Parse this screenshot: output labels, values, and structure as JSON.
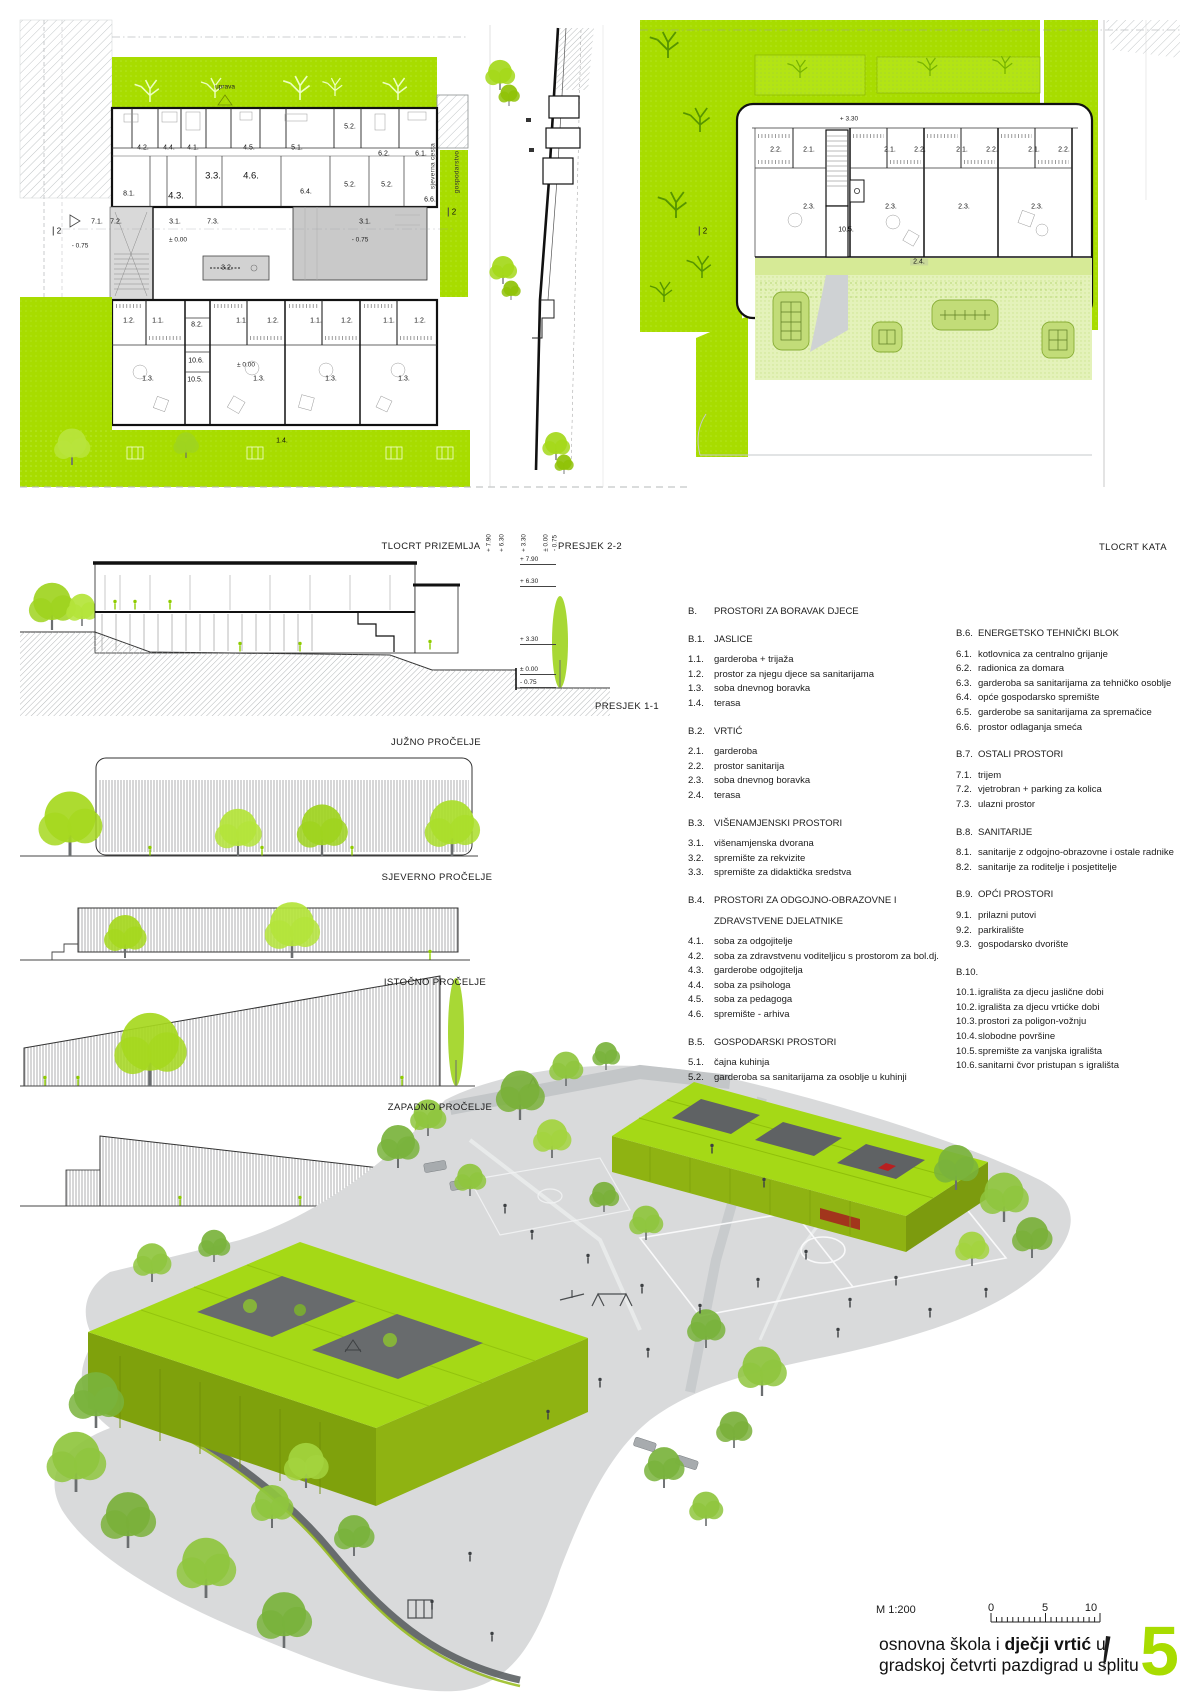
{
  "colors": {
    "accent_green": "#a8dc00",
    "roof_green": "#a5d916",
    "building_face_green": "#8fb312",
    "light_green": "#e4f2ba",
    "terrace_green": "#d6ea96",
    "hall_gray": "#c9c9c9",
    "render_ground_gray": "#d9dadb",
    "red_accent": "#b82020"
  },
  "captions": {
    "ground_plan": "TLOCRT PRIZEMLJA",
    "section22": "PRESJEK 2-2",
    "upper_plan": "TLOCRT KATA",
    "section11": "PRESJEK 1-1",
    "south_elev": "JUŽNO PROČELJE",
    "north_elev": "SJEVERNO PROČELJE",
    "east_elev": "ISTOČNO PROČELJE",
    "west_elev": "ZAPADNO PROČELJE"
  },
  "caption_levels": [
    {
      "t": "+ 7.90",
      "x": 489,
      "y": 543
    },
    {
      "t": "+ 6.30",
      "x": 502,
      "y": 543
    },
    {
      "t": "+ 3.30",
      "x": 524,
      "y": 543
    },
    {
      "t": "± 0.00",
      "x": 546,
      "y": 543
    },
    {
      "t": "- 0.75",
      "x": 555,
      "y": 543
    }
  ],
  "ground_plan": {
    "labels": [
      {
        "t": "4.2.",
        "x": 143,
        "y": 148
      },
      {
        "t": "4.4.",
        "x": 169,
        "y": 148
      },
      {
        "t": "4.1.",
        "x": 193,
        "y": 148
      },
      {
        "t": "4.5.",
        "x": 249,
        "y": 148
      },
      {
        "t": "5.1.",
        "x": 297,
        "y": 148
      },
      {
        "t": "5.2.",
        "x": 350,
        "y": 127
      },
      {
        "t": "6.2.",
        "x": 384,
        "y": 154
      },
      {
        "t": "6.1.",
        "x": 421,
        "y": 154
      },
      {
        "t": "3.3.",
        "x": 213,
        "y": 176,
        "c": "big"
      },
      {
        "t": "4.6.",
        "x": 251,
        "y": 176,
        "c": "big"
      },
      {
        "t": "8.1.",
        "x": 129,
        "y": 194
      },
      {
        "t": "4.3.",
        "x": 176,
        "y": 196,
        "c": "big"
      },
      {
        "t": "6.4.",
        "x": 306,
        "y": 192
      },
      {
        "t": "5.2.",
        "x": 350,
        "y": 185
      },
      {
        "t": "5.2.",
        "x": 387,
        "y": 185
      },
      {
        "t": "6.6.",
        "x": 430,
        "y": 200
      },
      {
        "t": "7.1.",
        "x": 97,
        "y": 222
      },
      {
        "t": "7.2.",
        "x": 116,
        "y": 222
      },
      {
        "t": "3.1.",
        "x": 175,
        "y": 222
      },
      {
        "t": "7.3.",
        "x": 213,
        "y": 222
      },
      {
        "t": "± 0.00",
        "x": 178,
        "y": 240,
        "c": "lv"
      },
      {
        "t": "3.2.",
        "x": 227,
        "y": 268
      },
      {
        "t": "3.1.",
        "x": 365,
        "y": 222
      },
      {
        "t": "- 0.75",
        "x": 360,
        "y": 240,
        "c": "lv"
      },
      {
        "t": "- 0.75",
        "x": 80,
        "y": 246,
        "c": "lv"
      },
      {
        "t": "2",
        "x": 57,
        "y": 231,
        "c": "mark"
      },
      {
        "t": "2",
        "x": 452,
        "y": 212,
        "c": "mark"
      },
      {
        "t": "1.2.",
        "x": 129,
        "y": 321
      },
      {
        "t": "1.1.",
        "x": 158,
        "y": 321
      },
      {
        "t": "8.2.",
        "x": 197,
        "y": 325
      },
      {
        "t": "1.1.",
        "x": 242,
        "y": 321
      },
      {
        "t": "1.2.",
        "x": 273,
        "y": 321
      },
      {
        "t": "1.1.",
        "x": 316,
        "y": 321
      },
      {
        "t": "1.2.",
        "x": 347,
        "y": 321
      },
      {
        "t": "1.1.",
        "x": 389,
        "y": 321
      },
      {
        "t": "1.2.",
        "x": 420,
        "y": 321
      },
      {
        "t": "10.6.",
        "x": 196,
        "y": 361
      },
      {
        "t": "10.5.",
        "x": 195,
        "y": 380
      },
      {
        "t": "± 0.00",
        "x": 246,
        "y": 365,
        "c": "lv"
      },
      {
        "t": "1.3.",
        "x": 148,
        "y": 379
      },
      {
        "t": "1.3.",
        "x": 259,
        "y": 379
      },
      {
        "t": "1.3.",
        "x": 331,
        "y": 379
      },
      {
        "t": "1.3.",
        "x": 404,
        "y": 379
      },
      {
        "t": "1.4.",
        "x": 282,
        "y": 441
      },
      {
        "t": "uprava",
        "x": 225,
        "y": 87,
        "c": "lv"
      },
      {
        "t": "sjeverna cesta",
        "x": 433,
        "y": 166,
        "c": "rot"
      },
      {
        "t": "gospodarstvo",
        "x": 457,
        "y": 172,
        "c": "rot"
      }
    ]
  },
  "upper_plan": {
    "labels": [
      {
        "t": "+ 3.30",
        "x": 849,
        "y": 119,
        "c": "lv"
      },
      {
        "t": "2.2.",
        "x": 776,
        "y": 150
      },
      {
        "t": "2.1.",
        "x": 809,
        "y": 150
      },
      {
        "t": "2.1.",
        "x": 890,
        "y": 150
      },
      {
        "t": "2.2.",
        "x": 920,
        "y": 150
      },
      {
        "t": "2.1.",
        "x": 962,
        "y": 150
      },
      {
        "t": "2.2.",
        "x": 992,
        "y": 150
      },
      {
        "t": "2.1.",
        "x": 1034,
        "y": 150
      },
      {
        "t": "2.2.",
        "x": 1064,
        "y": 150
      },
      {
        "t": "2.3.",
        "x": 809,
        "y": 207
      },
      {
        "t": "2.3.",
        "x": 891,
        "y": 207
      },
      {
        "t": "2.3.",
        "x": 964,
        "y": 207
      },
      {
        "t": "2.3.",
        "x": 1037,
        "y": 207
      },
      {
        "t": "10.5.",
        "x": 846,
        "y": 230
      },
      {
        "t": "2.4.",
        "x": 919,
        "y": 262,
        "c": "chip"
      },
      {
        "t": "2",
        "x": 703,
        "y": 231,
        "c": "mark"
      }
    ]
  },
  "section11": {
    "levels": [
      {
        "t": "+ 7.90",
        "x": 520,
        "y": 556
      },
      {
        "t": "+ 6.30",
        "x": 520,
        "y": 578
      },
      {
        "t": "+ 3.30",
        "x": 520,
        "y": 636
      },
      {
        "t": "± 0.00",
        "x": 520,
        "y": 666
      },
      {
        "t": "- 0.75",
        "x": 520,
        "y": 679
      }
    ]
  },
  "legend": {
    "col1": [
      {
        "n": "B.",
        "t": "PROSTORI ZA BORAVAK DJECE",
        "c": "head"
      },
      {
        "n": "B.1.",
        "t": "JASLICE",
        "c": "head"
      },
      {
        "n": "1.1.",
        "t": "garderoba + trijaža"
      },
      {
        "n": "1.2.",
        "t": "prostor za njegu djece sa sanitarijama"
      },
      {
        "n": "1.3.",
        "t": "soba dnevnog boravka"
      },
      {
        "n": "1.4.",
        "t": "terasa"
      },
      {
        "n": "B.2.",
        "t": "VRTIĆ",
        "c": "head"
      },
      {
        "n": "2.1.",
        "t": "garderoba"
      },
      {
        "n": "2.2.",
        "t": "prostor sanitarija"
      },
      {
        "n": "2.3.",
        "t": "soba dnevnog boravka"
      },
      {
        "n": "2.4.",
        "t": "terasa"
      },
      {
        "n": "B.3.",
        "t": "VIŠENAMJENSKI PROSTORI",
        "c": "head"
      },
      {
        "n": "3.1.",
        "t": "višenamjenska dvorana"
      },
      {
        "n": "3.2.",
        "t": "spremište za rekvizite"
      },
      {
        "n": "3.3.",
        "t": "spremište za didaktička sredstva"
      },
      {
        "n": "B.4.",
        "t": "PROSTORI ZA ODGOJNO-OBRAZOVNE I",
        "c": "head"
      },
      {
        "n": "",
        "t": "ZDRAVSTVENE DJELATNIKE",
        "c": "head2"
      },
      {
        "n": "4.1.",
        "t": "soba za odgojitelje"
      },
      {
        "n": "4.2.",
        "t": "soba za zdravstvenu voditeljicu s prostorom za bol.dj."
      },
      {
        "n": "4.3.",
        "t": "garderobe odgojitelja"
      },
      {
        "n": "4.4.",
        "t": "soba za psihologa"
      },
      {
        "n": "4.5.",
        "t": "soba za pedagoga"
      },
      {
        "n": "4.6.",
        "t": "spremište - arhiva"
      },
      {
        "n": "B.5.",
        "t": "GOSPODARSKI PROSTORI",
        "c": "head"
      },
      {
        "n": "5.1.",
        "t": "čajna kuhinja"
      },
      {
        "n": "5.2.",
        "t": "garderoba sa sanitarijama za osoblje u kuhinji"
      }
    ],
    "col2": [
      {
        "n": "B.6.",
        "t": "ENERGETSKO TEHNIČKI BLOK",
        "c": "head"
      },
      {
        "n": "6.1.",
        "t": "kotlovnica za centralno grijanje"
      },
      {
        "n": "6.2.",
        "t": "radionica za domara"
      },
      {
        "n": "6.3.",
        "t": "garderoba sa sanitarijama za tehničko osoblje"
      },
      {
        "n": "6.4.",
        "t": "opće gospodarsko spremište"
      },
      {
        "n": "6.5.",
        "t": "garderobe sa sanitarijama za spremačice"
      },
      {
        "n": "6.6.",
        "t": "prostor odlaganja smeća"
      },
      {
        "n": "B.7.",
        "t": "OSTALI PROSTORI",
        "c": "head"
      },
      {
        "n": "7.1.",
        "t": "trijem"
      },
      {
        "n": "7.2.",
        "t": "vjetrobran + parking za kolica"
      },
      {
        "n": "7.3.",
        "t": "ulazni prostor"
      },
      {
        "n": "B.8.",
        "t": "SANITARIJE",
        "c": "head"
      },
      {
        "n": "8.1.",
        "t": "sanitarije z odgojno-obrazovne i ostale radnike"
      },
      {
        "n": "8.2.",
        "t": "sanitarije za roditelje i posjetitelje"
      },
      {
        "n": "B.9.",
        "t": "OPĆI PROSTORI",
        "c": "head"
      },
      {
        "n": "9.1.",
        "t": "prilazni putovi"
      },
      {
        "n": "9.2.",
        "t": "parkiralište"
      },
      {
        "n": "9.3.",
        "t": "gospodarsko dvorište"
      },
      {
        "n": "B.10.",
        "t": "",
        "c": "head"
      },
      {
        "n": "10.1.",
        "t": "igrališta za djecu jaslične dobi"
      },
      {
        "n": "10.2.",
        "t": "igrališta za djecu vrtićke dobi"
      },
      {
        "n": "10.3.",
        "t": "prostori za poligon-vožnju"
      },
      {
        "n": "10.4.",
        "t": "slobodne površine"
      },
      {
        "n": "10.5.",
        "t": "spremište za vanjska igrališta"
      },
      {
        "n": "10.6.",
        "t": "sanitarni čvor pristupan s igrališta"
      }
    ]
  },
  "footer": {
    "scale_label": "M 1:200",
    "ticks": [
      {
        "t": "0",
        "x": 991,
        "y": 1602
      },
      {
        "t": "5",
        "x": 1045,
        "y": 1602
      },
      {
        "t": "10",
        "x": 1091,
        "y": 1602
      }
    ],
    "title_prefix": "osnovna škola i ",
    "title_bold": "dječji vrtić",
    "title_suffix": " u",
    "title_line2": "gradskoj četvrti pazdigrad u splitu",
    "panel_number": "5"
  }
}
